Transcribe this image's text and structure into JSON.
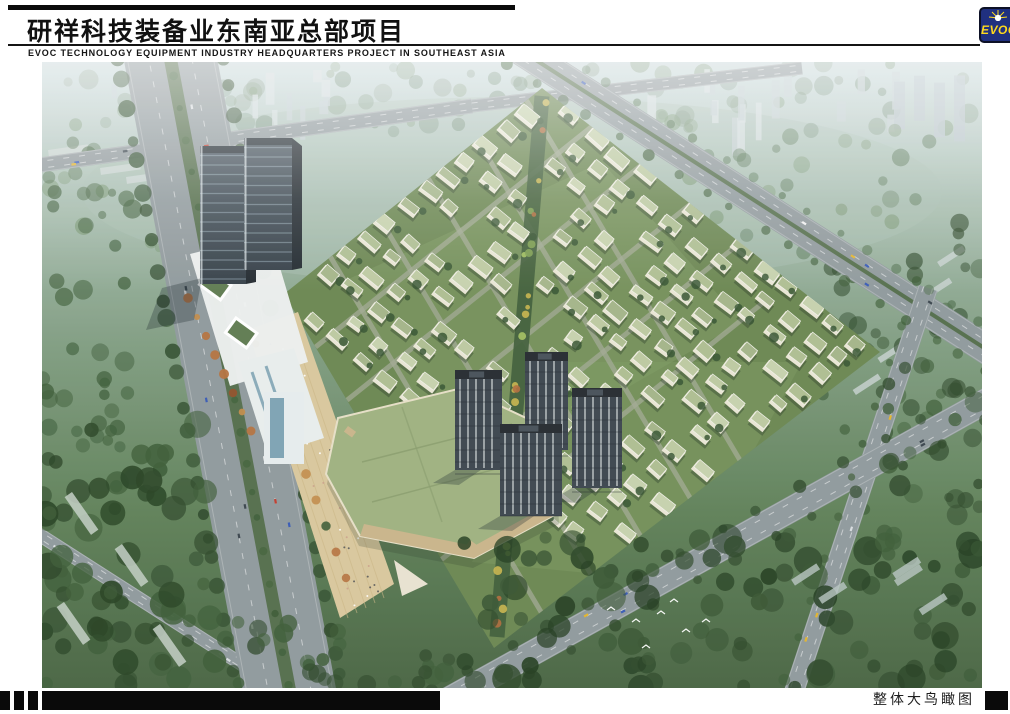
{
  "page": {
    "background": "#ffffff"
  },
  "header": {
    "title": "研祥科技装备业东南亚总部项目",
    "subtitle": "EVOC TECHNOLOGY EQUIPMENT INDUSTRY HEADQUARTERS PROJECT IN SOUTHEAST ASIA",
    "logo": {
      "text": "EVOC",
      "bg": "#20307f",
      "text_color": "#ffd91c"
    }
  },
  "footer": {
    "caption": "整体大鸟瞰图"
  },
  "scene": {
    "alt": "Aerial bird's-eye rendering: twin glass office towers with a white podium and mall beside a tree-lined boulevard, four dark residential high-rises, and a diamond-shaped campus of low-rise green-roofed buildings, all surrounded by forested city blocks and arterial roads fading into haze",
    "palette": {
      "skyTop": "#c9d9db",
      "hazeMid": "#a9bfb2",
      "groundMid": "#7f9c80",
      "groundLow": "#5d7f56",
      "groundBottom": "#466340",
      "treeDark": "#2b4627",
      "treeMid": "#3a5a34",
      "treeLight": "#6f8e66",
      "treeHaze": "#7d967f",
      "road": "#8e989b",
      "roadEdge": "#e8eaea",
      "median": "#4f6a45",
      "slabLight": "#ccd6d3",
      "slabHaze": "#c2ced1",
      "siteGreen": "#69854f",
      "sitePatch": "#7e9a62",
      "sitePath": "#a0a892",
      "spine": "#3c5a36",
      "villaWall": "#e9e6d4",
      "villaRoofs": [
        "#adbd90",
        "#bcc9a0",
        "#c6d1ac",
        "#a3b487"
      ],
      "towerGlassTop": "#45525c",
      "towerGlassBot": "#313c44",
      "towerSide": "#1e262c",
      "towerBand": "#93a7b2",
      "white": "#edf1ef",
      "glassBlue": "#7099ac",
      "mallRoof": "#9db07e",
      "mallWall": "#c9b488",
      "plaza": "#d9c79b",
      "resid": "#39434b",
      "residStripe": "#cdd4d4",
      "residRoof": "#22282d",
      "autumn": [
        "#b4703c",
        "#8f4f28",
        "#c08a48"
      ],
      "spineDots": [
        "#c8b44a",
        "#7da04f",
        "#a4c25e",
        "#b06a3a"
      ],
      "cars": [
        "#f2f2f2",
        "#d8dde0",
        "#c0392b",
        "#3558b5",
        "#e3b428",
        "#37424a"
      ],
      "shadow": "#152028"
    }
  }
}
